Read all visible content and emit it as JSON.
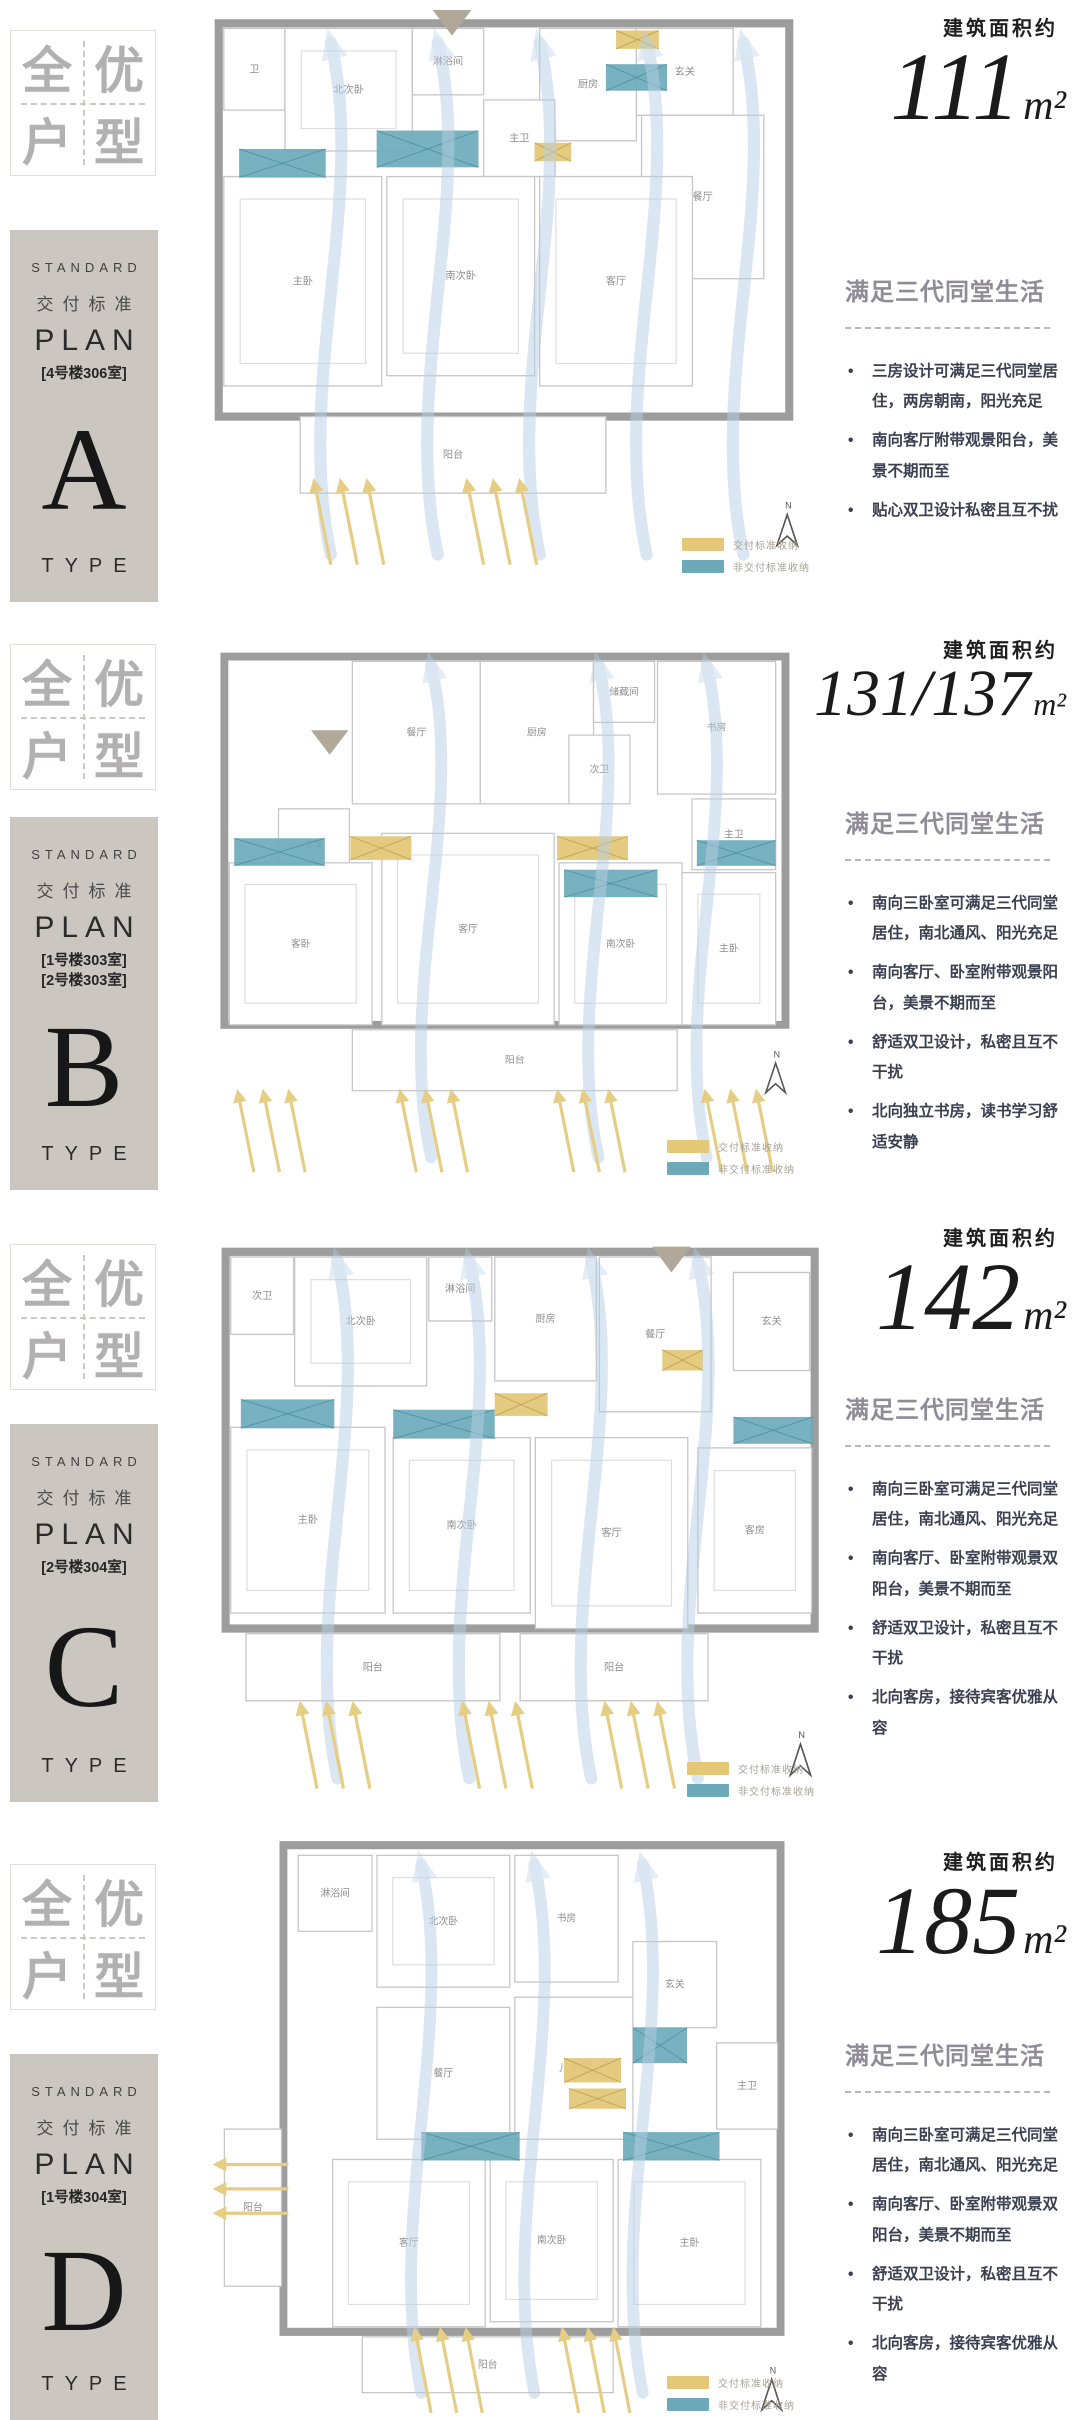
{
  "shared": {
    "badge_chars": [
      "全",
      "优",
      "户",
      "型"
    ],
    "block": {
      "standard": "STANDARD",
      "deliver": "交付标准",
      "plan": "PLAN",
      "type": "TYPE"
    },
    "area_label": "建筑面积约",
    "area_unit": "m²",
    "heading": "满足三代同堂生活",
    "legend": [
      {
        "label": "交付标准收纳",
        "color": "#e4c878"
      },
      {
        "label": "非交付标准收纳",
        "color": "#6caaba"
      }
    ],
    "compass_label": "N"
  },
  "colors": {
    "teal": "#6caaba",
    "teal_line": "#3f8396",
    "yellow": "#e4c878",
    "yellow_line": "#b59a4e",
    "flow": "#b7cfe4",
    "arrow": "#e6cd84",
    "wall": "#9d9d9d",
    "room_line": "#c7c7c7",
    "furniture": "#dedede",
    "room_text": "#8f8f8f",
    "marker": "#b2a89a",
    "compass": "#555555",
    "block_bg": "#cbc6c0"
  },
  "sections": [
    {
      "letter": "A",
      "tags": [
        "[4号楼306室]"
      ],
      "area": "111",
      "bullets": [
        "三房设计可满足三代同堂居住，两房朝南，阳光充足",
        "南向客厅附带观景阳台，美景不期而至",
        "贴心双卫设计私密且互不扰"
      ],
      "plan": {
        "vb": 560,
        "wall": [
          40,
          15,
          560,
          385
        ],
        "rooms": [
          [
            45,
            20,
            60,
            80,
            "卫"
          ],
          [
            105,
            20,
            125,
            120,
            "北次卧"
          ],
          [
            230,
            20,
            70,
            65,
            "淋浴间"
          ],
          [
            355,
            20,
            95,
            110,
            "厨房"
          ],
          [
            450,
            20,
            95,
            85,
            "玄关"
          ],
          [
            455,
            105,
            120,
            160,
            "餐厅"
          ],
          [
            300,
            90,
            70,
            75,
            "主卫"
          ],
          [
            45,
            165,
            155,
            205,
            "主卧"
          ],
          [
            205,
            165,
            145,
            195,
            "南次卧"
          ],
          [
            355,
            165,
            150,
            205,
            "客厅"
          ],
          [
            120,
            400,
            300,
            75,
            "阳台"
          ]
        ],
        "teal": [
          [
            60,
            138,
            85,
            28
          ],
          [
            195,
            120,
            100,
            36
          ],
          [
            420,
            55,
            60,
            26
          ]
        ],
        "yellow": [
          [
            430,
            22,
            42,
            18
          ],
          [
            350,
            132,
            36,
            18
          ]
        ],
        "flows": [
          150,
          255,
          355,
          460,
          555
        ],
        "arrows": [
          {
            "x": 150,
            "y": 545,
            "dir": "up"
          },
          {
            "x": 300,
            "y": 545,
            "dir": "up"
          }
        ],
        "marker": [
          250,
          2
        ],
        "compass": [
          598,
          512
        ]
      }
    },
    {
      "letter": "B",
      "tags": [
        "[1号楼303室]",
        "[2号楼303室]"
      ],
      "area": "131/137",
      "bullets": [
        "南向三卧室可满足三代同堂居住，南北通风、阳光充足",
        "南向客厅、卧室附带观景阳台，美景不期而至",
        "舒适双卫设计，私密且互不干扰",
        "北向独立书房，读书学习舒适安静"
      ],
      "plan": {
        "vb": 560,
        "wall": [
          40,
          25,
          570,
          375
        ],
        "rooms": [
          [
            170,
            30,
            130,
            145,
            "餐厅"
          ],
          [
            300,
            30,
            115,
            145,
            "厨房"
          ],
          [
            415,
            30,
            62,
            62,
            "储藏间"
          ],
          [
            480,
            30,
            120,
            135,
            "书房"
          ],
          [
            390,
            105,
            62,
            70,
            "次卫"
          ],
          [
            95,
            180,
            72,
            75,
            "玄关"
          ],
          [
            45,
            235,
            145,
            165,
            "客卧"
          ],
          [
            200,
            205,
            175,
            195,
            "客厅"
          ],
          [
            380,
            235,
            125,
            165,
            "南次卧"
          ],
          [
            515,
            170,
            85,
            72,
            "主卫"
          ],
          [
            505,
            245,
            95,
            155,
            "主卧"
          ],
          [
            170,
            405,
            330,
            62,
            "阳台"
          ]
        ],
        "teal": [
          [
            50,
            210,
            92,
            28
          ],
          [
            385,
            242,
            95,
            28
          ],
          [
            520,
            212,
            80,
            26
          ]
        ],
        "yellow": [
          [
            168,
            208,
            62,
            24
          ],
          [
            378,
            208,
            72,
            24
          ]
        ],
        "flows": [
          250,
          420,
          530
        ],
        "arrows": [
          {
            "x": 70,
            "y": 550,
            "dir": "up"
          },
          {
            "x": 235,
            "y": 550,
            "dir": "up"
          },
          {
            "x": 395,
            "y": 550,
            "dir": "up"
          },
          {
            "x": 545,
            "y": 550,
            "dir": "up"
          }
        ],
        "marker": [
          128,
          100
        ],
        "compass": [
          600,
          455
        ]
      }
    },
    {
      "letter": "C",
      "tags": [
        "[2号楼304室]"
      ],
      "area": "142",
      "bullets": [
        "南向三卧室可满足三代同堂居住，南北通风、阳光充足",
        "南向客厅、卧室附带观景双阳台，美景不期而至",
        "舒适双卫设计，私密且互不干扰",
        "北向客房，接待宾客优雅从容"
      ],
      "plan": {
        "vb": 560,
        "wall": [
          40,
          25,
          580,
          365
        ],
        "rooms": [
          [
            45,
            30,
            62,
            75,
            "次卫"
          ],
          [
            108,
            30,
            130,
            125,
            "北次卧"
          ],
          [
            240,
            30,
            62,
            62,
            "淋浴间"
          ],
          [
            305,
            30,
            100,
            120,
            "厨房"
          ],
          [
            408,
            30,
            110,
            150,
            "餐厅"
          ],
          [
            540,
            45,
            75,
            95,
            "玄关"
          ],
          [
            45,
            195,
            152,
            180,
            "主卧"
          ],
          [
            205,
            205,
            135,
            170,
            "南次卧"
          ],
          [
            345,
            205,
            150,
            185,
            "客厅"
          ],
          [
            505,
            215,
            112,
            160,
            "客房"
          ],
          [
            60,
            395,
            250,
            65,
            "阳台"
          ],
          [
            330,
            395,
            185,
            65,
            "阳台"
          ]
        ],
        "teal": [
          [
            55,
            168,
            92,
            28
          ],
          [
            205,
            178,
            100,
            28
          ],
          [
            540,
            185,
            78,
            26
          ]
        ],
        "yellow": [
          [
            305,
            162,
            52,
            22
          ],
          [
            470,
            120,
            40,
            20
          ]
        ],
        "flows": [
          150,
          280,
          400,
          505
        ],
        "arrows": [
          {
            "x": 130,
            "y": 545,
            "dir": "up"
          },
          {
            "x": 290,
            "y": 545,
            "dir": "up"
          },
          {
            "x": 430,
            "y": 545,
            "dir": "up"
          }
        ],
        "marker": [
          460,
          20
        ],
        "compass": [
          606,
          518
        ]
      }
    },
    {
      "letter": "D",
      "tags": [
        "[1号楼304室]"
      ],
      "area": "185",
      "bullets": [
        "南向三卧室可满足三代同堂居住，南北通风、阳光充足",
        "南向客厅、卧室附带观景双阳台，美景不期而至",
        "舒适双卫设计，私密且互不干扰",
        "北向客房，接待宾客优雅从容"
      ],
      "plan": {
        "vb": 580,
        "wall": [
          100,
          15,
          505,
          480
        ],
        "rooms": [
          [
            115,
            25,
            75,
            75,
            "淋浴间"
          ],
          [
            195,
            25,
            135,
            130,
            "北次卧"
          ],
          [
            335,
            25,
            105,
            125,
            "书房"
          ],
          [
            455,
            110,
            85,
            85,
            "玄关"
          ],
          [
            540,
            210,
            62,
            85,
            "主卫"
          ],
          [
            195,
            175,
            135,
            130,
            "餐厅"
          ],
          [
            335,
            165,
            120,
            140,
            "儿童区"
          ],
          [
            40,
            295,
            58,
            155,
            "阳台"
          ],
          [
            150,
            325,
            155,
            165,
            "客厅"
          ],
          [
            310,
            325,
            125,
            160,
            "南次卧"
          ],
          [
            440,
            325,
            145,
            165,
            "主卧"
          ],
          [
            180,
            500,
            255,
            55,
            "阳台"
          ]
        ],
        "teal": [
          [
            240,
            298,
            100,
            28
          ],
          [
            445,
            298,
            98,
            28
          ],
          [
            455,
            195,
            55,
            35
          ]
        ],
        "yellow": [
          [
            385,
            225,
            58,
            24
          ],
          [
            390,
            255,
            58,
            20
          ]
        ],
        "flows": [
          240,
          355,
          465
        ],
        "arrows": [
          {
            "x": 250,
            "y": 575,
            "dir": "up"
          },
          {
            "x": 400,
            "y": 575,
            "dir": "up"
          },
          {
            "x": 105,
            "y": 330,
            "dir": "left"
          }
        ],
        "marker": null,
        "compass": [
          596,
          558
        ]
      }
    }
  ]
}
